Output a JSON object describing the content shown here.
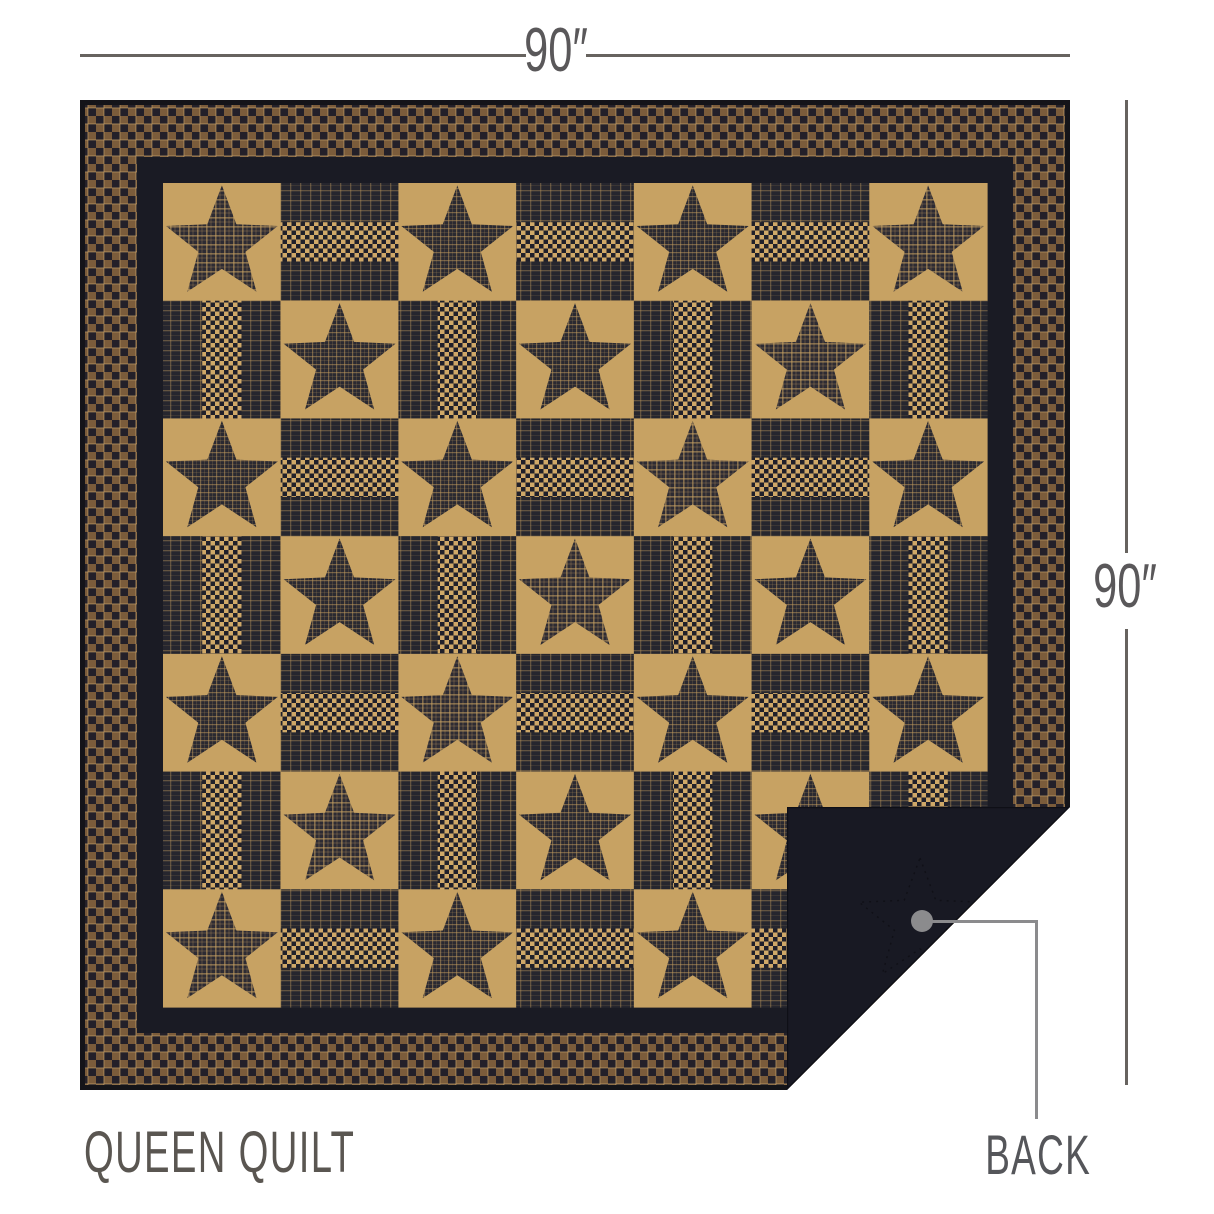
{
  "product": {
    "front_label": "QUEEN QUILT",
    "back_label": "BACK",
    "width_label": "90″",
    "height_label": "90″"
  },
  "annotation_style": {
    "dimension_line_color": "#67635f",
    "leader_color": "#8b8b8d",
    "label_color": "#5a5651"
  },
  "quilt": {
    "design": "star-and-rail-patchwork",
    "grid": 7,
    "rail_strips": 3,
    "fabrics": {
      "tan": "#c7a263",
      "star_plaid_base": "#2a2931",
      "star_plaid_line": "#c29c5e",
      "star_plaid2_base": "#2d2b33",
      "star_plaid2_line": "#c8a162",
      "rail_dark_base": "#26262e",
      "rail_dark_line": "#b8945a",
      "gingham_tan": "#cfa868",
      "gingham_navy": "#20202a",
      "outer_plaid_brown": "#7b5c3b",
      "outer_plaid_dark": "#232029",
      "outer_plaid_tan_line": "#c9a36a",
      "navy_border": "#1a1b24",
      "binding": "#141419",
      "backing": "#181923",
      "fold_edge": "#0e0f16"
    },
    "borders_px": {
      "binding": 5,
      "plaid": 52,
      "navy": 26
    },
    "size_px": 990,
    "fold": {
      "crease_from": [
        990,
        707
      ],
      "crease_to": [
        707,
        990
      ],
      "flap_corner": [
        707,
        707
      ],
      "stitch_star_center": [
        840,
        822
      ],
      "stitch_star_radius": 64
    }
  }
}
